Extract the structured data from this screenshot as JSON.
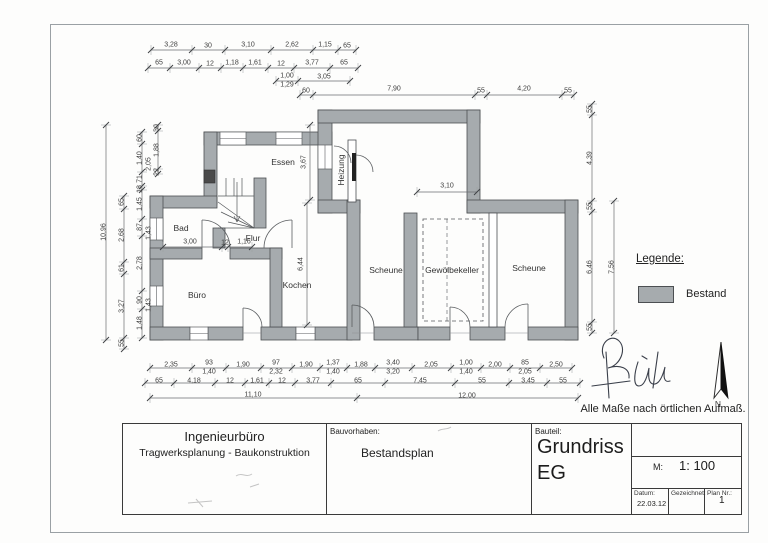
{
  "page": {
    "note": "Alle Maße nach örtlichen Aufmaß."
  },
  "legend": {
    "title": "Legende:",
    "items": [
      {
        "label": "Bestand",
        "color": "#a6abae"
      }
    ]
  },
  "compass": {
    "label": "N"
  },
  "colors": {
    "wall_fill": "#a6abae",
    "wall_stroke": "#4c4f52",
    "dim_line": "#6a6d70",
    "accent_dark": "#1c1c1c"
  },
  "plan": {
    "rooms": [
      {
        "t": "Essen",
        "x": 283,
        "y": 162
      },
      {
        "t": "Heizung",
        "x": 341,
        "y": 170,
        "r": 1
      },
      {
        "t": "Bad",
        "x": 181,
        "y": 228
      },
      {
        "t": "Flur",
        "x": 253,
        "y": 238
      },
      {
        "t": "Büro",
        "x": 197,
        "y": 295
      },
      {
        "t": "Kochen",
        "x": 297,
        "y": 285
      },
      {
        "t": "Scheune",
        "x": 386,
        "y": 270
      },
      {
        "t": "Gewölbekeller",
        "x": 452,
        "y": 270
      },
      {
        "t": "Scheune",
        "x": 529,
        "y": 268
      }
    ],
    "dims": [
      {
        "t": "3,28",
        "x": 171,
        "y": 45
      },
      {
        "t": "30",
        "x": 208,
        "y": 46
      },
      {
        "t": "3,10",
        "x": 248,
        "y": 45
      },
      {
        "t": "2,62",
        "x": 292,
        "y": 45
      },
      {
        "t": "1,15",
        "x": 325,
        "y": 45
      },
      {
        "t": "65",
        "x": 347,
        "y": 46
      },
      {
        "t": "65",
        "x": 159,
        "y": 63
      },
      {
        "t": "3,00",
        "x": 184,
        "y": 63
      },
      {
        "t": "12",
        "x": 210,
        "y": 64
      },
      {
        "t": "1,18",
        "x": 232,
        "y": 63
      },
      {
        "t": "1,61",
        "x": 255,
        "y": 63
      },
      {
        "t": "12",
        "x": 281,
        "y": 64
      },
      {
        "t": "3,77",
        "x": 312,
        "y": 63
      },
      {
        "t": "65",
        "x": 344,
        "y": 63
      },
      {
        "t": "1,00",
        "x": 287,
        "y": 76
      },
      {
        "t": "1,29",
        "x": 287,
        "y": 85
      },
      {
        "t": "3,05",
        "x": 324,
        "y": 77
      },
      {
        "t": "60",
        "x": 306,
        "y": 91
      },
      {
        "t": "7,90",
        "x": 394,
        "y": 89
      },
      {
        "t": "55",
        "x": 481,
        "y": 91
      },
      {
        "t": "4,20",
        "x": 524,
        "y": 89
      },
      {
        "t": "55",
        "x": 568,
        "y": 91
      },
      {
        "t": "55",
        "x": 590,
        "y": 109,
        "r": 1
      },
      {
        "t": "4,39",
        "x": 590,
        "y": 158,
        "r": 1
      },
      {
        "t": "55",
        "x": 590,
        "y": 206,
        "r": 1
      },
      {
        "t": "6,46",
        "x": 590,
        "y": 267,
        "r": 1
      },
      {
        "t": "55",
        "x": 590,
        "y": 327,
        "r": 1
      },
      {
        "t": "7,56",
        "x": 612,
        "y": 267,
        "r": 1
      },
      {
        "t": "10,96",
        "x": 104,
        "y": 232,
        "r": 1
      },
      {
        "t": "65",
        "x": 122,
        "y": 202,
        "r": 1
      },
      {
        "t": "2,68",
        "x": 122,
        "y": 235,
        "r": 1
      },
      {
        "t": "61",
        "x": 122,
        "y": 268,
        "r": 1
      },
      {
        "t": "3,27",
        "x": 122,
        "y": 306,
        "r": 1
      },
      {
        "t": "55",
        "x": 122,
        "y": 343,
        "r": 1
      },
      {
        "t": "60",
        "x": 140,
        "y": 138,
        "r": 1
      },
      {
        "t": "1,40",
        "x": 140,
        "y": 158,
        "r": 1
      },
      {
        "t": "71",
        "x": 140,
        "y": 179,
        "r": 1
      },
      {
        "t": "18",
        "x": 140,
        "y": 189,
        "r": 1
      },
      {
        "t": "1,45",
        "x": 140,
        "y": 204,
        "r": 1
      },
      {
        "t": "87",
        "x": 140,
        "y": 227,
        "r": 1
      },
      {
        "t": "2,78",
        "x": 140,
        "y": 263,
        "r": 1
      },
      {
        "t": "90",
        "x": 140,
        "y": 300,
        "r": 1
      },
      {
        "t": "1,48",
        "x": 140,
        "y": 323,
        "r": 1
      },
      {
        "t": "2,05",
        "x": 149,
        "y": 164,
        "r": 1
      },
      {
        "t": "1,43",
        "x": 149,
        "y": 233,
        "r": 1
      },
      {
        "t": "1,43",
        "x": 149,
        "y": 305,
        "r": 1
      },
      {
        "t": "30",
        "x": 157,
        "y": 128,
        "r": 1
      },
      {
        "t": "1,88",
        "x": 157,
        "y": 150,
        "r": 1
      },
      {
        "t": "22",
        "x": 157,
        "y": 172,
        "r": 1
      },
      {
        "t": "2,35",
        "x": 171,
        "y": 365
      },
      {
        "t": "93",
        "x": 209,
        "y": 363
      },
      {
        "t": "1,40",
        "x": 209,
        "y": 372
      },
      {
        "t": "1,90",
        "x": 243,
        "y": 365
      },
      {
        "t": "97",
        "x": 276,
        "y": 363
      },
      {
        "t": "2,32",
        "x": 276,
        "y": 372
      },
      {
        "t": "1,90",
        "x": 306,
        "y": 365
      },
      {
        "t": "1,37",
        "x": 333,
        "y": 363
      },
      {
        "t": "1,40",
        "x": 333,
        "y": 372
      },
      {
        "t": "1,88",
        "x": 361,
        "y": 365
      },
      {
        "t": "3,40",
        "x": 393,
        "y": 363
      },
      {
        "t": "3,20",
        "x": 393,
        "y": 372
      },
      {
        "t": "2,05",
        "x": 431,
        "y": 365
      },
      {
        "t": "1,00",
        "x": 466,
        "y": 363
      },
      {
        "t": "1,40",
        "x": 466,
        "y": 372
      },
      {
        "t": "2,00",
        "x": 495,
        "y": 365
      },
      {
        "t": "85",
        "x": 525,
        "y": 363
      },
      {
        "t": "2,05",
        "x": 525,
        "y": 372
      },
      {
        "t": "2,50",
        "x": 556,
        "y": 365
      },
      {
        "t": "65",
        "x": 159,
        "y": 381
      },
      {
        "t": "4,18",
        "x": 194,
        "y": 381
      },
      {
        "t": "12",
        "x": 230,
        "y": 381
      },
      {
        "t": "1,61",
        "x": 257,
        "y": 381
      },
      {
        "t": "12",
        "x": 282,
        "y": 381
      },
      {
        "t": "3,77",
        "x": 313,
        "y": 381
      },
      {
        "t": "65",
        "x": 358,
        "y": 381
      },
      {
        "t": "7,45",
        "x": 420,
        "y": 381
      },
      {
        "t": "55",
        "x": 482,
        "y": 381
      },
      {
        "t": "3,45",
        "x": 528,
        "y": 381
      },
      {
        "t": "55",
        "x": 563,
        "y": 381
      },
      {
        "t": "11,10",
        "x": 253,
        "y": 395
      },
      {
        "t": "12,00",
        "x": 467,
        "y": 396
      },
      {
        "t": "3,00",
        "x": 190,
        "y": 242
      },
      {
        "t": "12",
        "x": 225,
        "y": 243
      },
      {
        "t": "1,16",
        "x": 244,
        "y": 242
      },
      {
        "t": "3,67",
        "x": 304,
        "y": 162,
        "r": 1
      },
      {
        "t": "6,44",
        "x": 301,
        "y": 264,
        "r": 1
      },
      {
        "t": "3,10",
        "x": 447,
        "y": 186
      }
    ]
  },
  "title_block": {
    "company": "Ingenieurbüro",
    "company_sub": "Tragwerksplanung - Baukonstruktion",
    "project_label": "Bauvorhaben:",
    "project": "Bestandsplan",
    "part_label": "Bauteil:",
    "part_line1": "Grundriss",
    "part_line2": "EG",
    "scale_label": "M:",
    "scale": "1: 100",
    "date_label": "Datum:",
    "date": "22.03.12",
    "drawn_label": "Gezeichnet:",
    "plan_no_label": "Plan Nr.:",
    "plan_no": "1"
  }
}
